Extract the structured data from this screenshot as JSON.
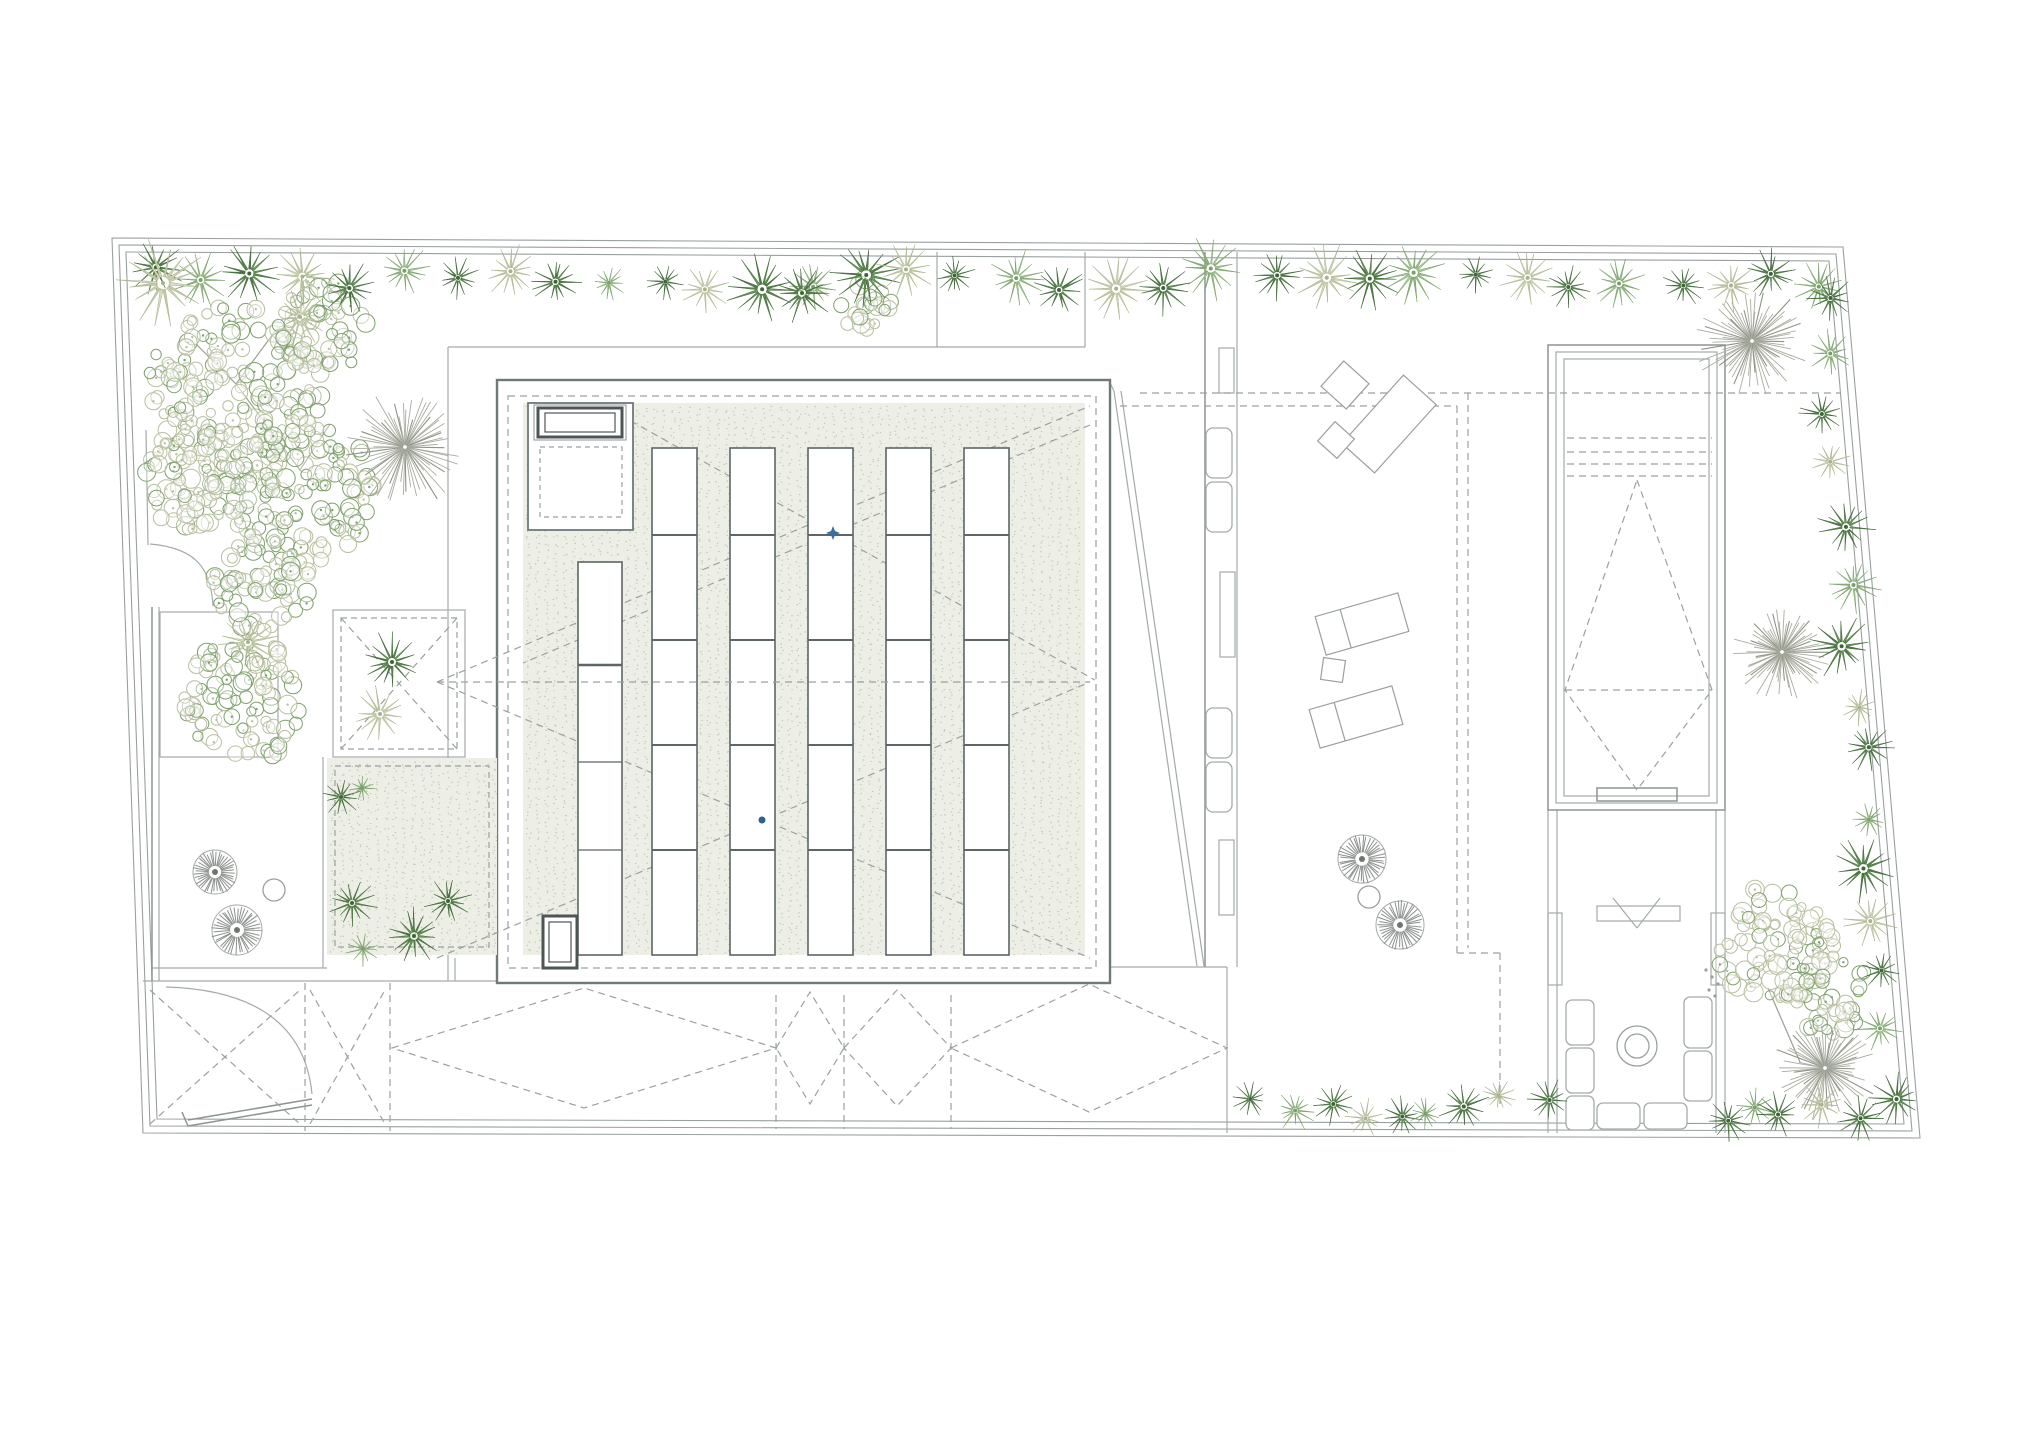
{
  "meta": {
    "plan_name": "roof-site-plan",
    "visible_text": []
  },
  "canvas": {
    "width": 2038,
    "height": 1440,
    "background": "#ffffff"
  },
  "palette": {
    "fence": "#9aa0a0",
    "thin": "#a4aaaa",
    "wall": "#8d9494",
    "building": "#6f7979",
    "dark": "#4d5555",
    "sky": "#5d6565",
    "dash": "#9aa1a1",
    "stipple_bg": "#edefe6",
    "stipple_dot1": "#c6cdb9",
    "stipple_dot2": "#b7c0a9",
    "burst": "#a9aca0",
    "burst_dark": "#8f9386",
    "fan": "#8b908c",
    "branch": "#9aa094",
    "marker_star": "#3a6f9f",
    "marker_dot": "#2f5f90",
    "furn": "#9aa0a0",
    "star_dark_fill": [
      "#5e8a50",
      "#6d9a5e",
      "#4f7c44"
    ],
    "star_dark_stroke": "#3e6637",
    "star_light_fill": [
      "#9dbd8b",
      "#aecb9d",
      "#8fb07e"
    ],
    "star_light_stroke": "#79a06a",
    "star_pale_fill": [
      "#cdd3b2",
      "#d8dcc0",
      "#c2c9a6"
    ],
    "star_pale_stroke": "#a9b28c",
    "bubble_pale": "#b9bf9f",
    "bubble_green": "#7ea06b"
  },
  "fence_outlines": [
    [
      [
        112,
        238
      ],
      [
        1843,
        247
      ],
      [
        1920,
        1138
      ],
      [
        143,
        1133
      ]
    ],
    [
      [
        119,
        245
      ],
      [
        1836,
        254
      ],
      [
        1912,
        1131
      ],
      [
        150,
        1126
      ]
    ],
    [
      [
        126,
        252
      ],
      [
        1829,
        261
      ],
      [
        1904,
        1124
      ],
      [
        157,
        1119
      ]
    ]
  ],
  "lines": [
    {
      "p": [
        448,
        347,
        1085,
        347
      ],
      "s": "thin"
    },
    {
      "p": [
        937,
        252,
        937,
        347
      ],
      "s": "thin"
    },
    {
      "p": [
        1085,
        252,
        1085,
        347
      ],
      "s": "thin"
    },
    {
      "p": [
        448,
        347,
        448,
        981
      ],
      "s": "thin"
    },
    {
      "p": [
        143,
        981,
        497,
        981
      ],
      "s": "thin"
    },
    {
      "p": [
        152,
        968,
        327,
        968
      ],
      "s": "thin"
    },
    {
      "p": [
        323,
        757,
        323,
        968
      ],
      "s": "thin"
    },
    {
      "p": [
        152,
        607,
        152,
        981
      ],
      "s": "wall"
    },
    {
      "p": [
        159,
        607,
        159,
        981
      ],
      "s": "thin"
    },
    {
      "p": [
        146,
        430,
        148,
        545
      ],
      "s": "thin"
    },
    {
      "p": [
        1110,
        967,
        1227,
        967
      ],
      "s": "thin"
    },
    {
      "p": [
        1227,
        967,
        1227,
        1133
      ],
      "s": "thin"
    },
    {
      "p": [
        455,
        958,
        455,
        981
      ],
      "s": "thin"
    },
    {
      "p": [
        1114,
        391,
        1197,
        966
      ],
      "s": "thin"
    },
    {
      "p": [
        1121,
        391,
        1204,
        966
      ],
      "s": "thin"
    },
    {
      "p": [
        1110,
        383,
        1114,
        391
      ],
      "s": "thin"
    },
    {
      "p": [
        1205,
        252,
        1205,
        967
      ],
      "s": "wall"
    },
    {
      "p": [
        1237,
        252,
        1237,
        967
      ],
      "s": "thin"
    },
    {
      "p": [
        1548,
        810,
        1548,
        1133
      ],
      "s": "thin"
    },
    {
      "p": [
        1557,
        810,
        1557,
        1133
      ],
      "s": "thin"
    },
    {
      "p": [
        1716,
        810,
        1716,
        1133
      ],
      "s": "thin"
    },
    {
      "p": [
        1725,
        810,
        1725,
        1133
      ],
      "s": "thin"
    },
    {
      "p": [
        1613,
        898,
        1637,
        928
      ],
      "s": "thin"
    },
    {
      "p": [
        1660,
        898,
        1637,
        928
      ],
      "s": "thin"
    },
    {
      "p": [
        188,
        1120,
        312,
        1099
      ],
      "s": "wall"
    },
    {
      "p": [
        188,
        1126,
        312,
        1105
      ],
      "s": "wall"
    },
    {
      "p": [
        182,
        1112,
        188,
        1126
      ],
      "s": "wall"
    }
  ],
  "rects": [
    {
      "x": 160,
      "y": 612,
      "w": 118,
      "h": 145,
      "s": "thin"
    },
    {
      "x": 333,
      "y": 610,
      "w": 132,
      "h": 147,
      "s": "thin"
    },
    {
      "x": 1548,
      "y": 345,
      "w": 177,
      "h": 465,
      "s": "wall"
    },
    {
      "x": 1556,
      "y": 352,
      "w": 161,
      "h": 451,
      "s": "thin"
    },
    {
      "x": 1564,
      "y": 359,
      "w": 145,
      "h": 437,
      "s": "thin"
    },
    {
      "x": 1597,
      "y": 788,
      "w": 80,
      "h": 13,
      "s": "wall"
    },
    {
      "x": 1597,
      "y": 906,
      "w": 83,
      "h": 15,
      "s": "thin"
    },
    {
      "x": 1548,
      "y": 913,
      "w": 14,
      "h": 72,
      "s": "thin"
    },
    {
      "x": 1711,
      "y": 913,
      "w": 14,
      "h": 72,
      "s": "thin"
    },
    {
      "x": 1219,
      "y": 348,
      "w": 15,
      "h": 45,
      "s": "thin"
    },
    {
      "x": 1220,
      "y": 572,
      "w": 15,
      "h": 85,
      "s": "thin"
    },
    {
      "x": 1219,
      "y": 840,
      "w": 15,
      "h": 75,
      "s": "thin"
    }
  ],
  "rounded_rects": [
    {
      "x": 1206,
      "y": 428,
      "w": 26,
      "h": 50,
      "rx": 7
    },
    {
      "x": 1206,
      "y": 482,
      "w": 26,
      "h": 50,
      "rx": 7
    },
    {
      "x": 1206,
      "y": 708,
      "w": 26,
      "h": 50,
      "rx": 7
    },
    {
      "x": 1206,
      "y": 762,
      "w": 26,
      "h": 50,
      "rx": 7
    },
    {
      "x": 1566,
      "y": 1000,
      "w": 28,
      "h": 45,
      "rx": 6
    },
    {
      "x": 1566,
      "y": 1048,
      "w": 28,
      "h": 45,
      "rx": 6
    },
    {
      "x": 1566,
      "y": 1096,
      "w": 28,
      "h": 34,
      "rx": 6
    },
    {
      "x": 1684,
      "y": 997,
      "w": 28,
      "h": 51,
      "rx": 6
    },
    {
      "x": 1684,
      "y": 1051,
      "w": 28,
      "h": 50,
      "rx": 6
    },
    {
      "x": 1597,
      "y": 1103,
      "w": 43,
      "h": 26,
      "rx": 6
    },
    {
      "x": 1644,
      "y": 1103,
      "w": 43,
      "h": 26,
      "rx": 6
    }
  ],
  "building": {
    "x": 497,
    "y": 380,
    "w": 613,
    "h": 603
  },
  "access_box": {
    "x": 528,
    "y": 403,
    "w": 105,
    "h": 127
  },
  "hatch1": [
    {
      "x": 534,
      "y": 405,
      "w": 92,
      "h": 35,
      "s": "wall",
      "w2": 1
    },
    {
      "x": 538,
      "y": 408,
      "w": 84,
      "h": 29,
      "s": "dark",
      "w2": 3
    },
    {
      "x": 545,
      "y": 413,
      "w": 70,
      "h": 19,
      "s": "dark",
      "w2": 1.2
    }
  ],
  "hatch2": [
    {
      "x": 543,
      "y": 916,
      "w": 34,
      "h": 52,
      "s": "dark",
      "w2": 3
    },
    {
      "x": 549,
      "y": 922,
      "w": 22,
      "h": 40,
      "s": "dark",
      "w2": 1.2
    }
  ],
  "skylights": {
    "short_col": {
      "x": 578,
      "y": 562,
      "w": 44,
      "h": 393,
      "dividers": [
        [
          665,
          2.6
        ],
        [
          762,
          1.3
        ],
        [
          850,
          1.3
        ]
      ]
    },
    "cols_x": [
      652,
      730,
      808,
      886,
      964
    ],
    "col": {
      "y": 448,
      "w": 45,
      "h": 507,
      "dividers": [
        535,
        640,
        745,
        850
      ]
    }
  },
  "stipple": [
    {
      "x": 523,
      "y": 403,
      "w": 562,
      "h": 552
    },
    {
      "x": 327,
      "y": 758,
      "w": 170,
      "h": 197
    }
  ],
  "dashed_lines": [
    [
      620,
      415,
      1095,
      680
    ],
    [
      1090,
      425,
      523,
      663
    ],
    [
      437,
      682,
      1090,
      958
    ],
    [
      437,
      682,
      1090,
      406
    ],
    [
      437,
      958,
      1090,
      682
    ],
    [
      1140,
      393,
      1840,
      393
    ],
    [
      1120,
      406,
      1457,
      406
    ],
    [
      1457,
      406,
      1457,
      953
    ],
    [
      1468,
      393,
      1468,
      948
    ],
    [
      1457,
      953,
      1500,
      953
    ],
    [
      1500,
      953,
      1500,
      1105
    ],
    [
      341,
      618,
      457,
      749
    ],
    [
      457,
      618,
      341,
      749
    ],
    [
      1567,
      438,
      1712,
      438
    ],
    [
      1567,
      452,
      1712,
      452
    ],
    [
      1567,
      464,
      1712,
      464
    ],
    [
      1567,
      476,
      1712,
      476
    ],
    [
      1565,
      690,
      1712,
      690
    ],
    [
      305,
      983,
      305,
      1131
    ],
    [
      390,
      983,
      390,
      1131
    ],
    [
      776,
      995,
      776,
      1129
    ],
    [
      844,
      995,
      844,
      1129
    ],
    [
      951,
      995,
      951,
      1129
    ],
    [
      150,
      990,
      300,
      1124
    ],
    [
      150,
      1124,
      300,
      990
    ],
    [
      310,
      990,
      385,
      1124
    ],
    [
      310,
      1124,
      385,
      990
    ]
  ],
  "dashed_line_over": [
    437,
    682,
    1090,
    682
  ],
  "dashed_rects": [
    {
      "x": 508,
      "y": 396,
      "w": 588,
      "h": 572,
      "dash": "7 5"
    },
    {
      "x": 341,
      "y": 618,
      "w": 116,
      "h": 131,
      "dash": "6 4"
    },
    {
      "x": 335,
      "y": 766,
      "w": 154,
      "h": 181,
      "dash": "6 4"
    },
    {
      "x": 540,
      "y": 447,
      "w": 82,
      "h": 70,
      "dash": "5 4"
    }
  ],
  "dashed_polygons": [
    [
      [
        1637,
        480
      ],
      [
        1712,
        690
      ],
      [
        1637,
        790
      ],
      [
        1565,
        690
      ]
    ],
    [
      [
        392,
        1048
      ],
      [
        584,
        988
      ],
      [
        776,
        1048
      ],
      [
        584,
        1108
      ]
    ],
    [
      [
        776,
        1048
      ],
      [
        810,
        992
      ],
      [
        844,
        1048
      ],
      [
        810,
        1104
      ]
    ],
    [
      [
        844,
        1048
      ],
      [
        897,
        990
      ],
      [
        951,
        1048
      ],
      [
        897,
        1106
      ]
    ],
    [
      [
        951,
        1048
      ],
      [
        1089,
        984
      ],
      [
        1227,
        1048
      ],
      [
        1089,
        1112
      ]
    ]
  ],
  "arcs": [
    {
      "d": "M150,544 C196,548 211,568 213,606"
    },
    {
      "d": "M312,1094 C304,1012 236,989 166,987"
    }
  ],
  "plant_rows": [
    {
      "x1": 150,
      "y1": 276,
      "x2": 1828,
      "y2": 281,
      "n": 34,
      "rmin": 16,
      "rmax": 32
    },
    {
      "x1": 1822,
      "y1": 303,
      "x2": 1889,
      "y2": 1090,
      "n": 15,
      "rmin": 16,
      "rmax": 30
    },
    {
      "x1": 1256,
      "y1": 1106,
      "x2": 1540,
      "y2": 1107,
      "n": 9,
      "rmin": 14,
      "rmax": 24
    },
    {
      "x1": 1723,
      "y1": 1111,
      "x2": 1853,
      "y2": 1112,
      "n": 5,
      "rmin": 14,
      "rmax": 22
    }
  ],
  "plants_extra": [
    [
      163,
      283,
      40,
      "pale"
    ],
    [
      300,
      317,
      26,
      "pale"
    ],
    [
      802,
      293,
      27,
      "dark"
    ],
    [
      392,
      662,
      27,
      "dark"
    ],
    [
      380,
      714,
      25,
      "pale"
    ],
    [
      248,
      642,
      26,
      "pale"
    ],
    [
      341,
      797,
      17,
      "dark"
    ],
    [
      362,
      788,
      13,
      "light"
    ],
    [
      352,
      903,
      22,
      "dark"
    ],
    [
      414,
      936,
      26,
      "dark"
    ],
    [
      363,
      949,
      15,
      "light"
    ],
    [
      448,
      901,
      21,
      "dark"
    ]
  ],
  "bursts": [
    [
      405,
      447,
      62
    ],
    [
      1752,
      341,
      58
    ],
    [
      1782,
      652,
      50
    ],
    [
      1825,
      1068,
      55
    ]
  ],
  "fans": [
    [
      215,
      872,
      22
    ],
    [
      237,
      930,
      25
    ],
    [
      1362,
      859,
      24
    ],
    [
      1400,
      925,
      24
    ]
  ],
  "plain_circles": [
    {
      "cx": 274,
      "cy": 890,
      "r": 11
    },
    {
      "cx": 1369,
      "cy": 897,
      "r": 11
    },
    {
      "cx": 1637,
      "cy": 1046,
      "r": 20
    },
    {
      "cx": 1637,
      "cy": 1046,
      "r": 12
    }
  ],
  "bubbles": [
    [
      235,
      395,
      95,
      0.62
    ],
    [
      300,
      490,
      80,
      0.5
    ],
    [
      195,
      480,
      58,
      0.78
    ],
    [
      320,
      328,
      55,
      0.45
    ],
    [
      262,
      585,
      55,
      0.55
    ],
    [
      245,
      700,
      68,
      0.5
    ],
    [
      1775,
      945,
      65,
      0.72
    ],
    [
      1832,
      995,
      46,
      0.4
    ],
    [
      865,
      306,
      33,
      0.6
    ]
  ],
  "branches": [
    [
      300,
      470,
      236,
      384
    ],
    [
      236,
      384,
      196,
      344
    ],
    [
      236,
      384,
      276,
      330
    ],
    [
      300,
      470,
      330,
      424
    ],
    [
      1800,
      1062,
      1768,
      988
    ]
  ],
  "dot_trail": [
    [
      1706,
      970
    ],
    [
      1712,
      977
    ],
    [
      1718,
      984
    ],
    [
      1709,
      990
    ],
    [
      1715,
      996
    ]
  ],
  "furniture": [
    {
      "cx": 1389,
      "cy": 424,
      "w": 92,
      "h": 44,
      "a": -48
    },
    {
      "cx": 1345,
      "cy": 385,
      "w": 34,
      "h": 34,
      "a": -48
    },
    {
      "cx": 1336,
      "cy": 440,
      "w": 26,
      "h": 26,
      "a": -48
    },
    {
      "cx": 1362,
      "cy": 624,
      "w": 86,
      "h": 40,
      "a": -16,
      "inner": 26
    },
    {
      "cx": 1333,
      "cy": 670,
      "w": 22,
      "h": 22,
      "a": 8
    },
    {
      "cx": 1356,
      "cy": 717,
      "w": 86,
      "h": 40,
      "a": -16,
      "inner": 26
    }
  ],
  "markers": {
    "star": {
      "cx": 833,
      "cy": 533
    },
    "dot": {
      "cx": 762,
      "cy": 820,
      "r": 3.5
    }
  }
}
